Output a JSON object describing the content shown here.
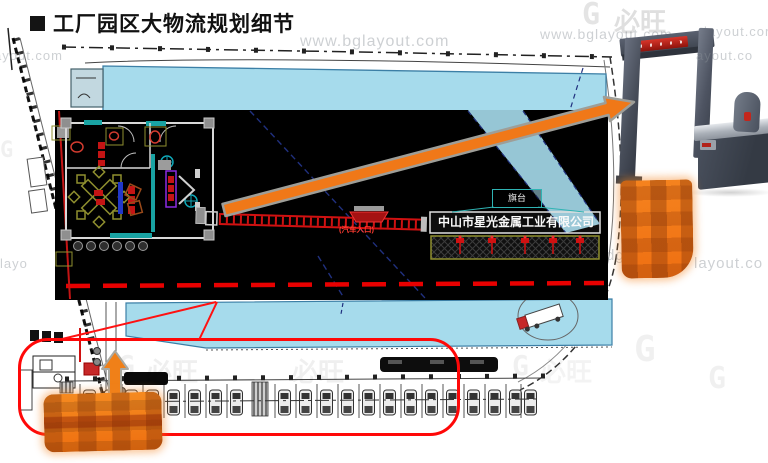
{
  "title": {
    "text": "工厂园区大物流规划细节"
  },
  "inset": {
    "flag_platform": "旗台",
    "company": "中山市星光金属工业有限公司",
    "car_entrance": "(汽车入口)"
  },
  "watermarks": {
    "full_url": "www.bglayout.com",
    "frag_left_top": "ayout.com",
    "frag_right_top": "layout.com",
    "frag_mid_right_1": "dglayout.c",
    "frag_mid_right_2": "layout.co",
    "frag_mid_right_3": "ut.co",
    "frag_gate": "ayout.co",
    "frag_left_low": "layo",
    "brand": "必旺",
    "logo_letter": "G"
  },
  "colors": {
    "accent_orange": "#F07818",
    "cad_red": "#D01111",
    "building_cyan": "#A6DBEC",
    "wall_teal": "#19A3A3",
    "navy_line": "#20307F",
    "highlight_red": "#FF0808",
    "detector_gray": "#4A515E"
  }
}
